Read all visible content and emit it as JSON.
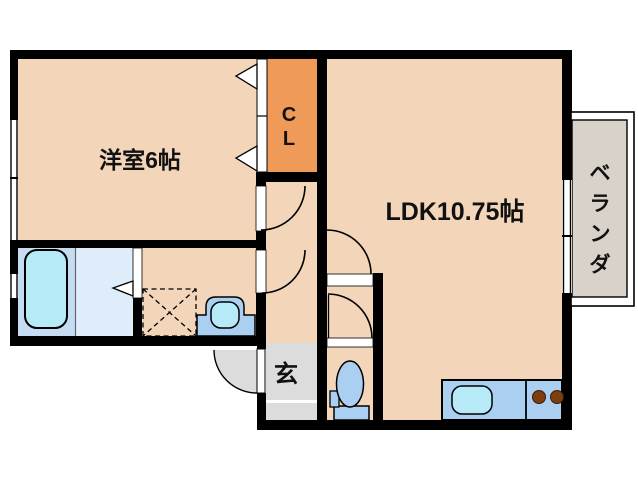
{
  "title": "apartment-floor-plan",
  "rooms": {
    "bedroom": {
      "label": "洋室6帖"
    },
    "ldk": {
      "label": "LDK10.75帖"
    },
    "closet": {
      "label_lines": [
        "C",
        "L"
      ]
    },
    "veranda": {
      "label_chars": [
        "ベ",
        "ラ",
        "ン",
        "ダ"
      ]
    },
    "entrance": {
      "label": "玄"
    }
  },
  "colors": {
    "wall": "#000000",
    "floor_peach": "#f3d5ba",
    "closet_orange": "#f09a5a",
    "veranda_gray": "#d9d2c9",
    "entrance_gray": "#dcdcdc",
    "bath_left_blue": "#c6dcf2",
    "bath_right_blue": "#dfecf9",
    "water_cyan": "#b7eaf7",
    "fixture_blue": "#abcff1",
    "burner_brown": "#7d3f10",
    "text": "#111111",
    "exterior": "#ffffff"
  }
}
